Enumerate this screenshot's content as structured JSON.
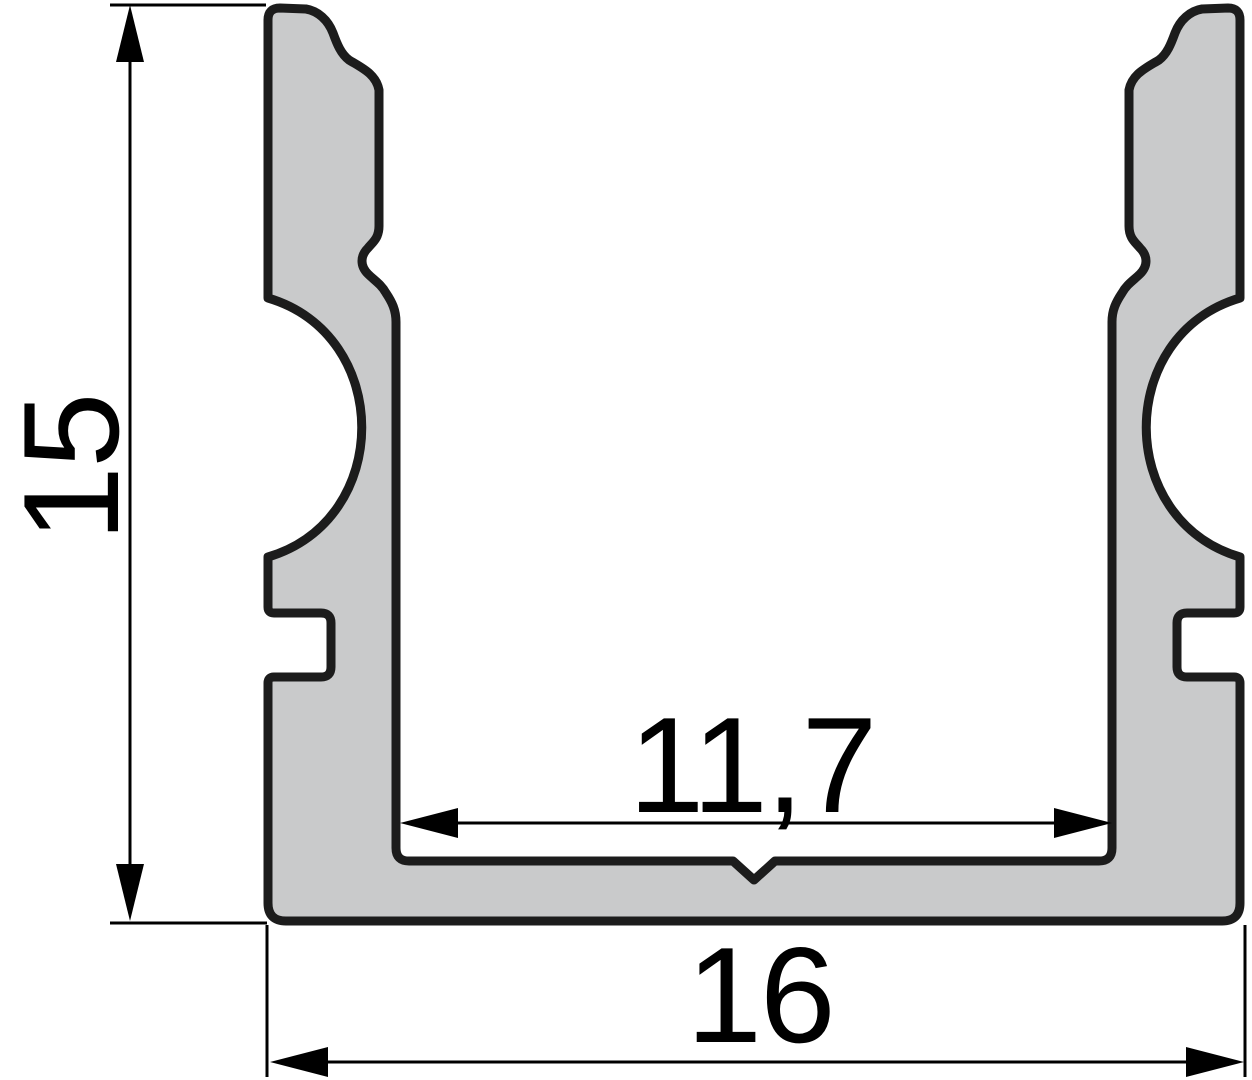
{
  "drawing": {
    "type": "technical-cross-section",
    "subject": "u-channel-profile",
    "dimensions": {
      "height": {
        "label": "15"
      },
      "inner_width": {
        "label": "11,7"
      },
      "outer_width": {
        "label": "16"
      }
    },
    "colors": {
      "background": "#ffffff",
      "profile_fill": "#c9cacb",
      "profile_stroke": "#1c1c1c",
      "dimension_color": "#000000"
    }
  }
}
